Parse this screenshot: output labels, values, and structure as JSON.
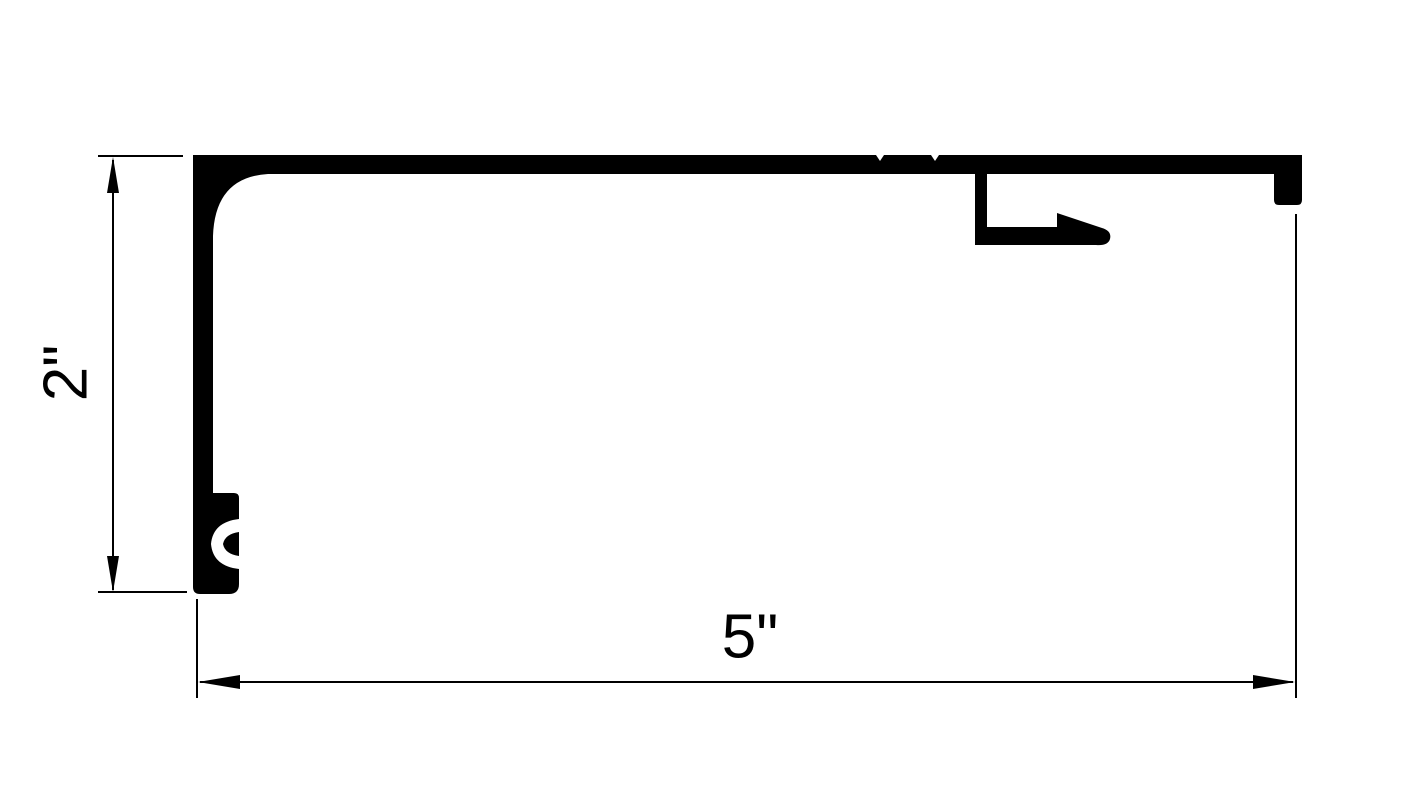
{
  "diagram": {
    "type": "dimensioned technical drawing (extrusion profile cross-section)",
    "background_color": "#ffffff",
    "ink_color": "#000000",
    "dimensions": {
      "height": {
        "label": "2\"",
        "orientation": "vertical"
      },
      "width": {
        "label": "5\"",
        "orientation": "horizontal"
      }
    }
  }
}
